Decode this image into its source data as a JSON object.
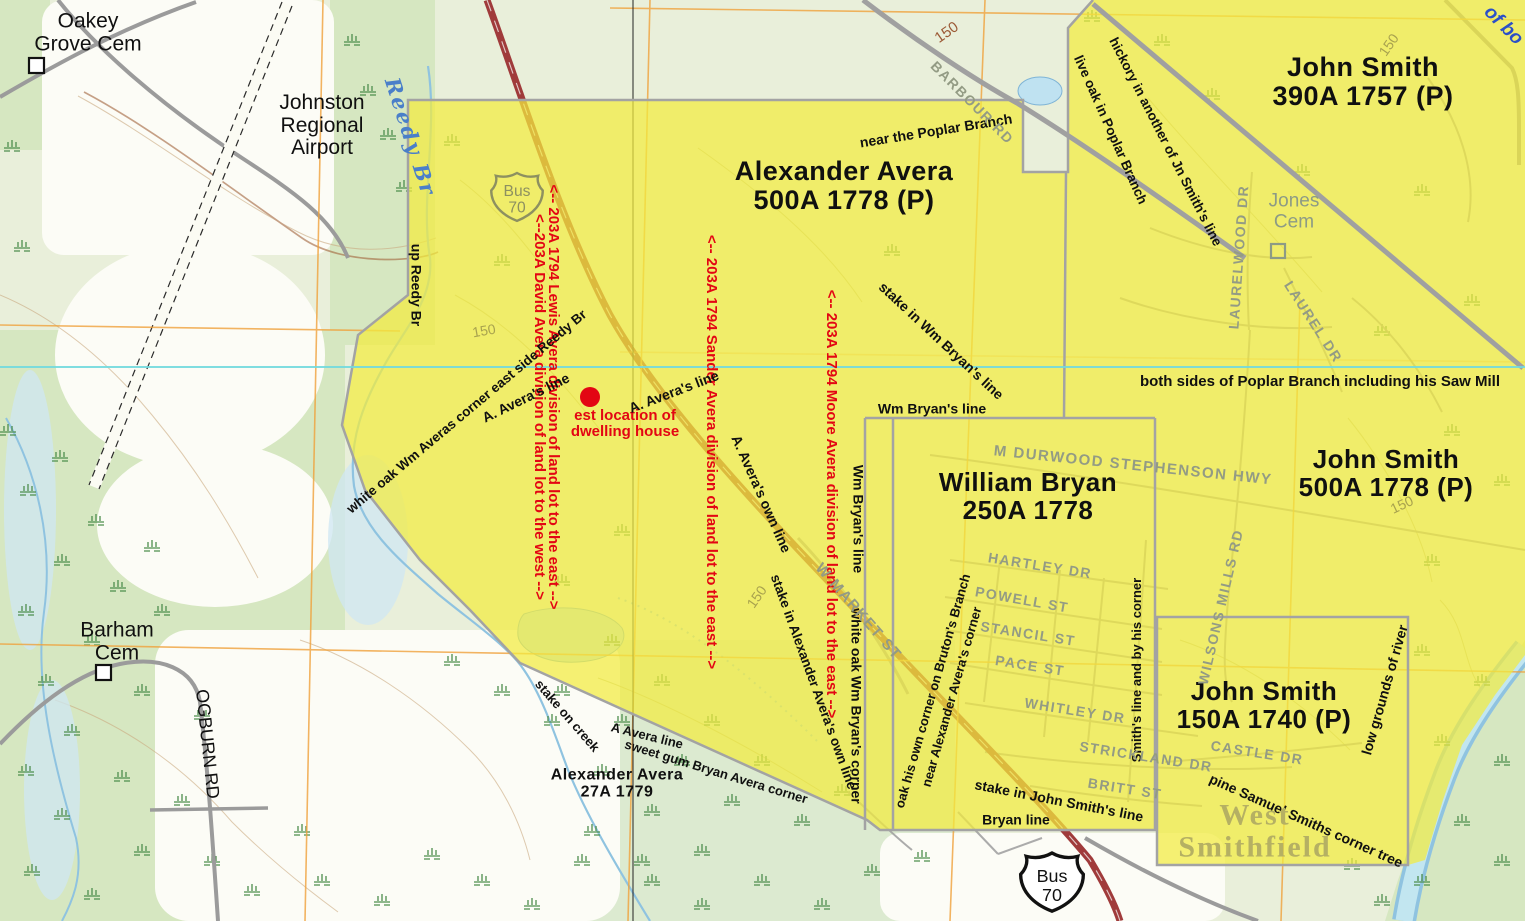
{
  "colors": {
    "yellow_overlay": "#f2ec3e",
    "red_annotation": "#e30613",
    "parcel_border_gray": "#a3a3a3",
    "street_label_gray": "#939b84",
    "highway_maroon": "#a03b3b",
    "water_blue": "#8fc3e0",
    "cyan_line": "#72dade",
    "orange_grid": "#f0a23c",
    "olive_text": "#b5b063",
    "cemetery_gray": "#8d9b85"
  },
  "parcels": [
    {
      "id": "avera500",
      "name": "Alexander Avera",
      "details": "500A 1778 (P)"
    },
    {
      "id": "smith390",
      "name": "John Smith",
      "details": "390A 1757 (P)"
    },
    {
      "id": "smith500",
      "name": "John Smith",
      "details": "500A 1778 (P)"
    },
    {
      "id": "bryan250",
      "name": "William Bryan",
      "details": "250A 1778"
    },
    {
      "id": "smith150",
      "name": "John Smith",
      "details": "150A 1740 (P)"
    },
    {
      "id": "avera27",
      "name": "Alexander Avera",
      "details": "27A 1779"
    }
  ],
  "red_annotations": [
    {
      "id": "lewis-division",
      "text": "<-- 203A 1794 Lewis Avera division of land lot to the east -->"
    },
    {
      "id": "david-division",
      "text": "<--203A David Avera division of land lot to the west -->"
    },
    {
      "id": "sander-division",
      "text": "<-- 203A 1794 Sander Avera division of land lot to the east -->"
    },
    {
      "id": "moore-division",
      "text": "<-- 203A 1794 Moore Avera division of land lot to the east -->"
    },
    {
      "id": "dwelling-house",
      "text": "est location of\ndwelling house"
    }
  ],
  "survey_annotations": [
    {
      "id": "up-reedy-br",
      "text": "up Reedy Br"
    },
    {
      "id": "white-oak-averas",
      "text": "white oak Wm Averas corner east side Reedy Br"
    },
    {
      "id": "avera-line-1",
      "text": "A. Avera's line"
    },
    {
      "id": "avera-line-2",
      "text": "A. Avera's line"
    },
    {
      "id": "avera-own-line",
      "text": "A. Avera's own line"
    },
    {
      "id": "stake-alexander",
      "text": "stake in Alexander Avera's own line"
    },
    {
      "id": "near-poplar",
      "text": "near the Poplar Branch"
    },
    {
      "id": "stake-wm-bryan",
      "text": "stake in Wm Bryan's line"
    },
    {
      "id": "wm-bryan-line-h",
      "text": "Wm Bryan's line"
    },
    {
      "id": "wm-bryan-line-v",
      "text": "Wm Bryan's line"
    },
    {
      "id": "white-oak-bryan",
      "text": "white oak Wm Bryan's corner"
    },
    {
      "id": "hickory-smith",
      "text": "hickory in another of Jn Smith's line"
    },
    {
      "id": "live-oak-poplar",
      "text": "live oak in Poplar Branch"
    },
    {
      "id": "both-sides-poplar",
      "text": "both sides of Poplar Branch including his Saw Mill"
    },
    {
      "id": "stake-on-creek",
      "text": "stake on creek"
    },
    {
      "id": "a-avera-line",
      "text": "A Avera line"
    },
    {
      "id": "sweet-gum",
      "text": "sweet gum Bryan Avera corner"
    },
    {
      "id": "stake-john-smith",
      "text": "stake in John Smith's line"
    },
    {
      "id": "bryan-line",
      "text": "Bryan line"
    },
    {
      "id": "oak-own-corner",
      "text": "oak his own corner on Bruton's Branch"
    },
    {
      "id": "near-alexander-corner",
      "text": "near Alexander Avera's corner"
    },
    {
      "id": "smiths-line-corner",
      "text": "Smith's line and by his corner"
    },
    {
      "id": "pine-samuel",
      "text": "pine Samuel Smiths corner tree"
    },
    {
      "id": "low-grounds",
      "text": "low grounds of river"
    }
  ],
  "street_labels": [
    {
      "id": "stephenson-hwy",
      "text": "M DURWOOD STEPHENSON HWY"
    },
    {
      "id": "hartley-dr",
      "text": "HARTLEY DR"
    },
    {
      "id": "powell-st",
      "text": "POWELL ST"
    },
    {
      "id": "stancil-st",
      "text": "STANCIL ST"
    },
    {
      "id": "pace-st",
      "text": "PACE ST"
    },
    {
      "id": "whitley-dr",
      "text": "WHITLEY DR"
    },
    {
      "id": "strickland-dr",
      "text": "STRICKLAND DR"
    },
    {
      "id": "britt-st",
      "text": "BRITT ST"
    },
    {
      "id": "castle-dr",
      "text": "CASTLE DR"
    },
    {
      "id": "wilsons-mills-rd",
      "text": "WILSONS MILLS RD"
    },
    {
      "id": "laurelwood-dr",
      "text": "LAURELWOOD DR"
    },
    {
      "id": "laurel-dr",
      "text": "LAUREL DR"
    },
    {
      "id": "w-market-st",
      "text": "W MARKET ST"
    },
    {
      "id": "barbour-rd",
      "text": "BARBOUR RD"
    }
  ],
  "place_labels": [
    {
      "id": "oakey-grove-cem",
      "text": "Oakey\nGrove Cem"
    },
    {
      "id": "johnston-airport",
      "text": "Johnston\nRegional\nAirport"
    },
    {
      "id": "barham-cem",
      "text": "Barham\nCem"
    },
    {
      "id": "ogburn-rd",
      "text": "OGBURN RD"
    },
    {
      "id": "jones-cem",
      "text": "Jones\nCem"
    },
    {
      "id": "west-smithfield",
      "text": "West\nSmithfield"
    }
  ],
  "water_labels": [
    {
      "id": "reedy-br",
      "text": "Reedy Br"
    },
    {
      "id": "of-bo",
      "text": "of bo"
    }
  ],
  "contour_labels": [
    {
      "id": "c150-a",
      "text": "150"
    },
    {
      "id": "c150-b",
      "text": "150"
    },
    {
      "id": "c150-c",
      "text": "150"
    },
    {
      "id": "c150-d",
      "text": "150"
    },
    {
      "id": "c150-e",
      "text": "150"
    }
  ],
  "highway_shields": [
    {
      "id": "bus70-top",
      "line1": "Bus",
      "line2": "70"
    },
    {
      "id": "bus70-bottom",
      "line1": "Bus",
      "line2": "70"
    }
  ]
}
